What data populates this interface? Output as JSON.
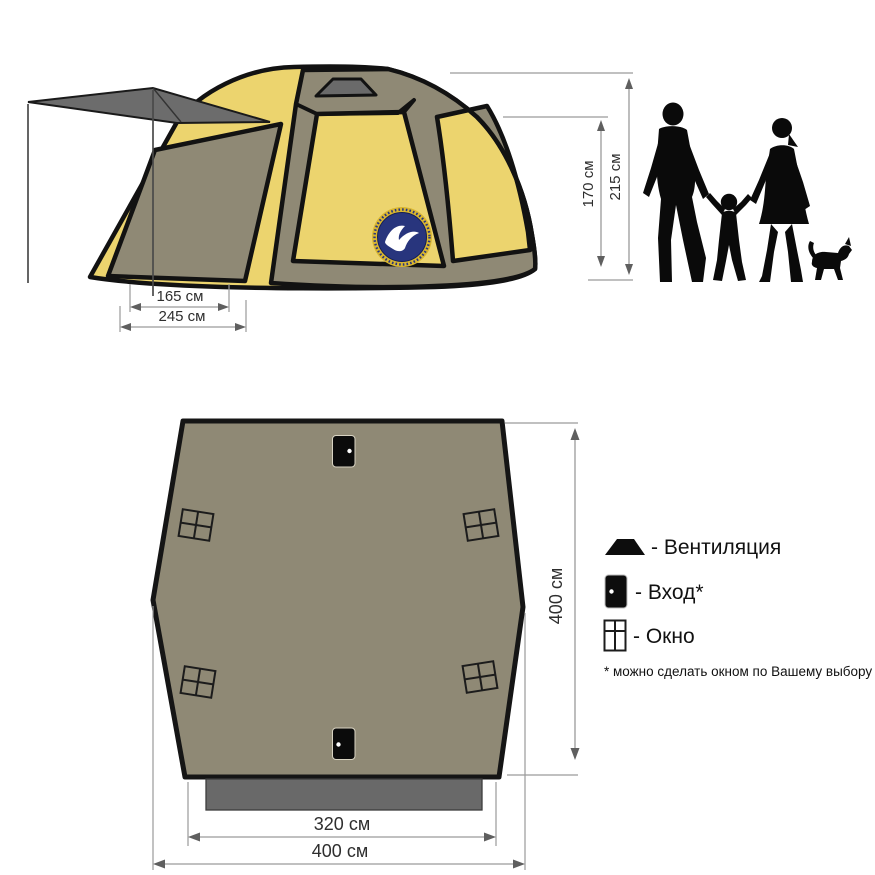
{
  "side_view": {
    "dimensions": {
      "height_inner": "170 см",
      "height_outer": "215 см",
      "depth_inner": "165 см",
      "depth_outer": "245 см"
    },
    "logo": "World of Maverick emblem"
  },
  "floor_plan": {
    "dimensions": {
      "height": "400 см",
      "width_inner": "320 см",
      "width_outer": "400 см"
    }
  },
  "legend": {
    "items": [
      {
        "icon": "vent-icon",
        "label": "- Вентиляция"
      },
      {
        "icon": "door-icon",
        "label": "- Вход*"
      },
      {
        "icon": "window-icon",
        "label": "- Окно"
      }
    ],
    "footnote": "* можно сделать окном по Вашему выбору"
  },
  "palette": {
    "tent_yellow": "#ecd46e",
    "tent_khaki": "#8f8975",
    "dark_gray": "#6a6a6a",
    "outline_black": "#121212",
    "logo_blue": "#28357d",
    "logo_gold": "#d9b62f",
    "dim_line_gray": "#9a9a9a"
  }
}
